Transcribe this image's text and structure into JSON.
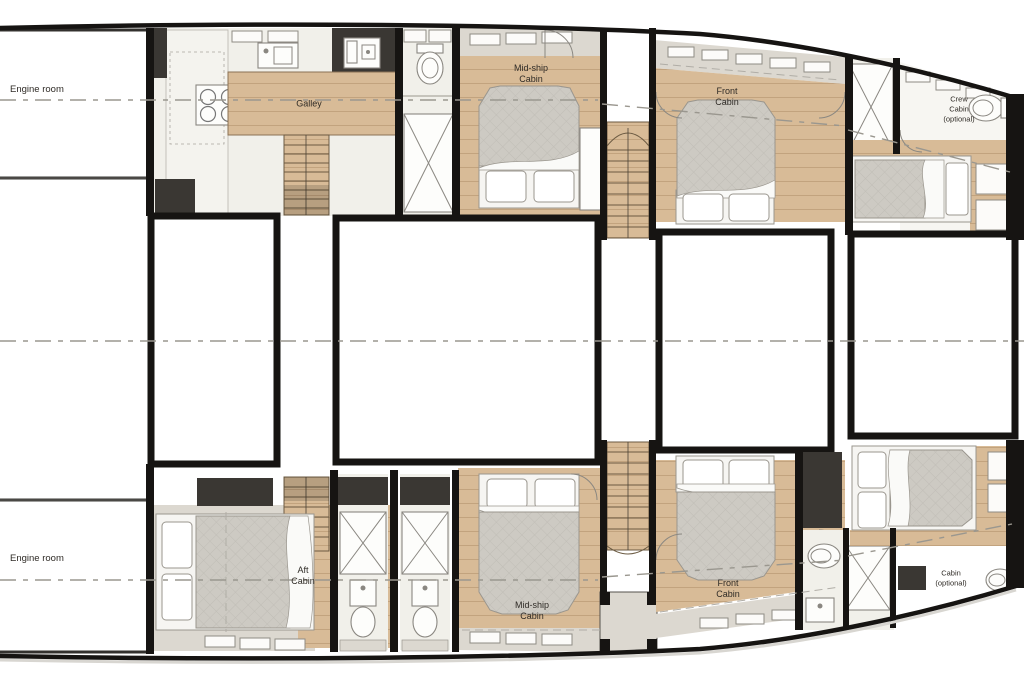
{
  "plan_type": "yacht-deck-floor-plan",
  "rooms": {
    "engine_room_port": {
      "label": "Engine room"
    },
    "galley": {
      "label": "Galley"
    },
    "midship_cabin_port": {
      "label": "Mid-ship\nCabin"
    },
    "front_cabin_port": {
      "label": "Front\nCabin"
    },
    "crew_cabin": {
      "label": "Crew\nCabin\n(optional)"
    },
    "engine_room_starboard": {
      "label": "Engine room"
    },
    "aft_cabin": {
      "label": "Aft\nCabin"
    },
    "midship_cabin_starboard": {
      "label": "Mid-ship\nCabin"
    },
    "front_cabin_starboard": {
      "label": "Front\nCabin"
    },
    "cabin_optional": {
      "label": "Cabin\n(optional)"
    }
  },
  "colors": {
    "wall": "#161412",
    "wood": "#d8bb97",
    "floor_light": "#f1f0ea",
    "cabinet_greige": "#dcd8d0",
    "dark_block": "#3a3733",
    "mattress": "#cdcac3",
    "dashed_line": "#9a978f",
    "label_text": "#2f2b26"
  }
}
